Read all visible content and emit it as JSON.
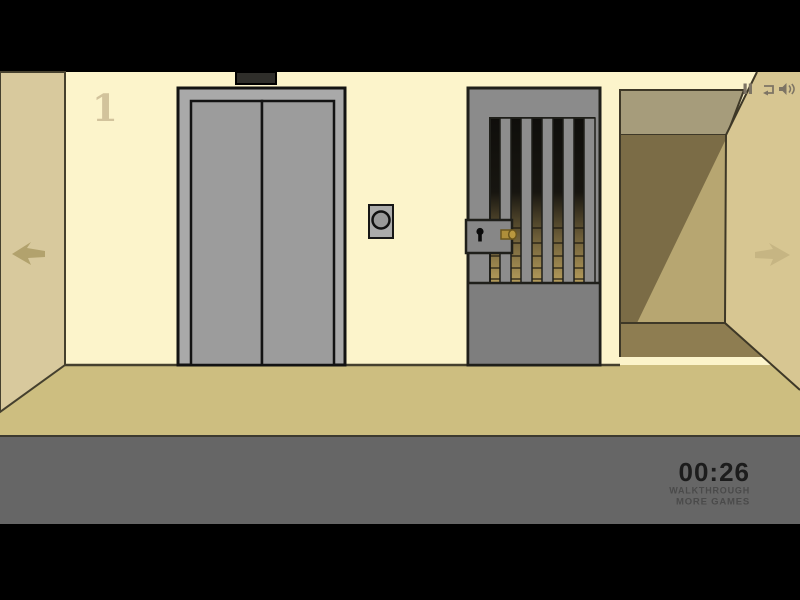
{
  "hud": {
    "timer": "00:26",
    "links": {
      "walkthrough": "WALKTHROUGH",
      "more_games": "MORE GAMES"
    },
    "icons": [
      "pause-icon",
      "replay-icon",
      "sound-icon"
    ]
  },
  "scene": {
    "floor_number": "1",
    "objects": {
      "elevator": "closed gray elevator doors with indicator panel above and round call button",
      "barred_gate": "gray jail gate with vertical bars, solid lower panel, lock box with keyhole and inserted brass key",
      "corridor": "perspective hallway opening on the right",
      "navigation": [
        "left-arrow-icon",
        "right-arrow-icon"
      ]
    },
    "colors": {
      "letterbox_black": "#000000",
      "wall_cream": "#fcf4cb",
      "left_wall_tan": "#d8c99d",
      "right_wall_tan": "#d7c692",
      "corridor_ceiling": "#a69c7b",
      "corridor_dark": "#7b6c46",
      "corridor_light": "#b7a671",
      "corridor_floor_shadow": "#8e7d51",
      "floor_tan": "#cdbe80",
      "bottom_bar_gray": "#666666",
      "elevator_gray": "#a9a9a9",
      "door_gray": "#9c9c9c",
      "gate_gray": "#8b8b8b",
      "key_gold": "#b2923c",
      "timer_text": "#1c1c1c",
      "link_text": "#4a4a4a",
      "outline_dark": "#3f3a2a"
    }
  }
}
